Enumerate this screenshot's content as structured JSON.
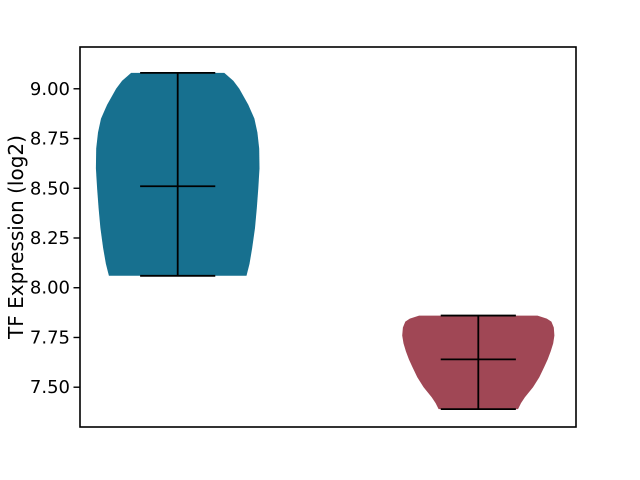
{
  "figure": {
    "background": "#ffffff"
  },
  "chart_data": {
    "type": "violin",
    "title": "",
    "xlabel": "",
    "ylabel": "TF Expression (log2)",
    "ylim": [
      7.3,
      9.21
    ],
    "xlim": [
      0.675,
      2.325
    ],
    "grid": false,
    "frame_box": true,
    "x_tick_labels": [],
    "yticks": [
      {
        "value": 9.0,
        "label": "9.00"
      },
      {
        "value": 8.75,
        "label": "8.75"
      },
      {
        "value": 8.5,
        "label": "8.50"
      },
      {
        "value": 8.25,
        "label": "8.25"
      },
      {
        "value": 8.0,
        "label": "8.00"
      },
      {
        "value": 7.75,
        "label": "7.75"
      },
      {
        "value": 7.5,
        "label": "7.50"
      }
    ],
    "stat_line_color": "#000000",
    "stat_bar_halfwidth": 0.125,
    "axis_color": "#000000",
    "series": [
      {
        "name": "violin-1",
        "position": 1,
        "fill_color": "#17708f",
        "stats": {
          "min": 8.06,
          "median": 8.51,
          "max": 9.08
        },
        "profile": [
          [
            9.08,
            0.155
          ],
          [
            9.04,
            0.185
          ],
          [
            9.0,
            0.205
          ],
          [
            8.92,
            0.235
          ],
          [
            8.85,
            0.255
          ],
          [
            8.78,
            0.265
          ],
          [
            8.7,
            0.271
          ],
          [
            8.6,
            0.272
          ],
          [
            8.5,
            0.268
          ],
          [
            8.4,
            0.263
          ],
          [
            8.3,
            0.257
          ],
          [
            8.2,
            0.248
          ],
          [
            8.12,
            0.239
          ],
          [
            8.06,
            0.229
          ]
        ]
      },
      {
        "name": "violin-2",
        "position": 2,
        "fill_color": "#a04755",
        "stats": {
          "min": 7.39,
          "median": 7.64,
          "max": 7.86
        },
        "profile": [
          [
            7.86,
            0.197
          ],
          [
            7.845,
            0.228
          ],
          [
            7.83,
            0.243
          ],
          [
            7.8,
            0.251
          ],
          [
            7.76,
            0.253
          ],
          [
            7.72,
            0.249
          ],
          [
            7.68,
            0.241
          ],
          [
            7.64,
            0.231
          ],
          [
            7.6,
            0.219
          ],
          [
            7.55,
            0.203
          ],
          [
            7.5,
            0.182
          ],
          [
            7.45,
            0.155
          ],
          [
            7.42,
            0.142
          ],
          [
            7.39,
            0.132
          ]
        ]
      }
    ]
  }
}
